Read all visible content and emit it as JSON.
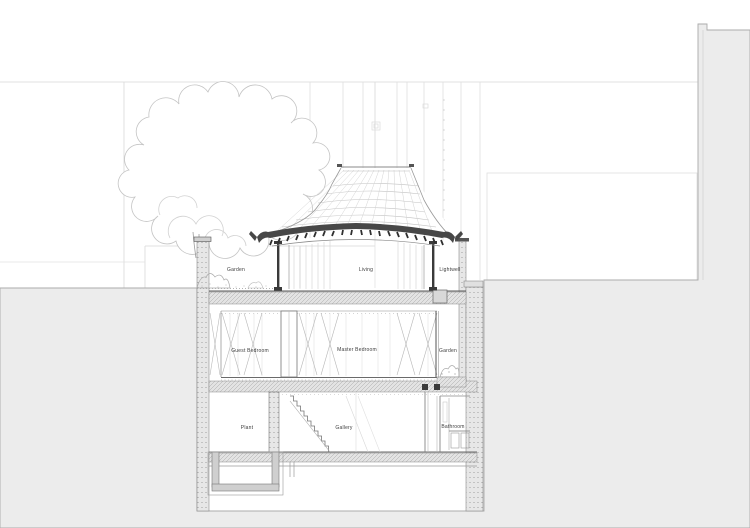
{
  "drawing": {
    "title": "building-cross-section",
    "type": "architectural-section",
    "sections": {
      "upper": {
        "garden": "Garden",
        "living": "Living",
        "lightwell": "Lightwell"
      },
      "bedroom": {
        "guest_bedroom": "Guest Bedroom",
        "master_bedroom": "Master Bedroom",
        "garden": "Garden"
      },
      "basement": {
        "plant": "Plant",
        "gallery": "Gallery",
        "bathroom": "Bathroom"
      }
    },
    "colors": {
      "paper": "#ffffff",
      "ground_fill": "#ececec",
      "ground_edge": "#aaaaaa",
      "eave_dark": "#424242",
      "line_faint": "#d6d6d6",
      "line_medium": "#8a8a8a",
      "line_dark": "#4a4a4a"
    }
  }
}
